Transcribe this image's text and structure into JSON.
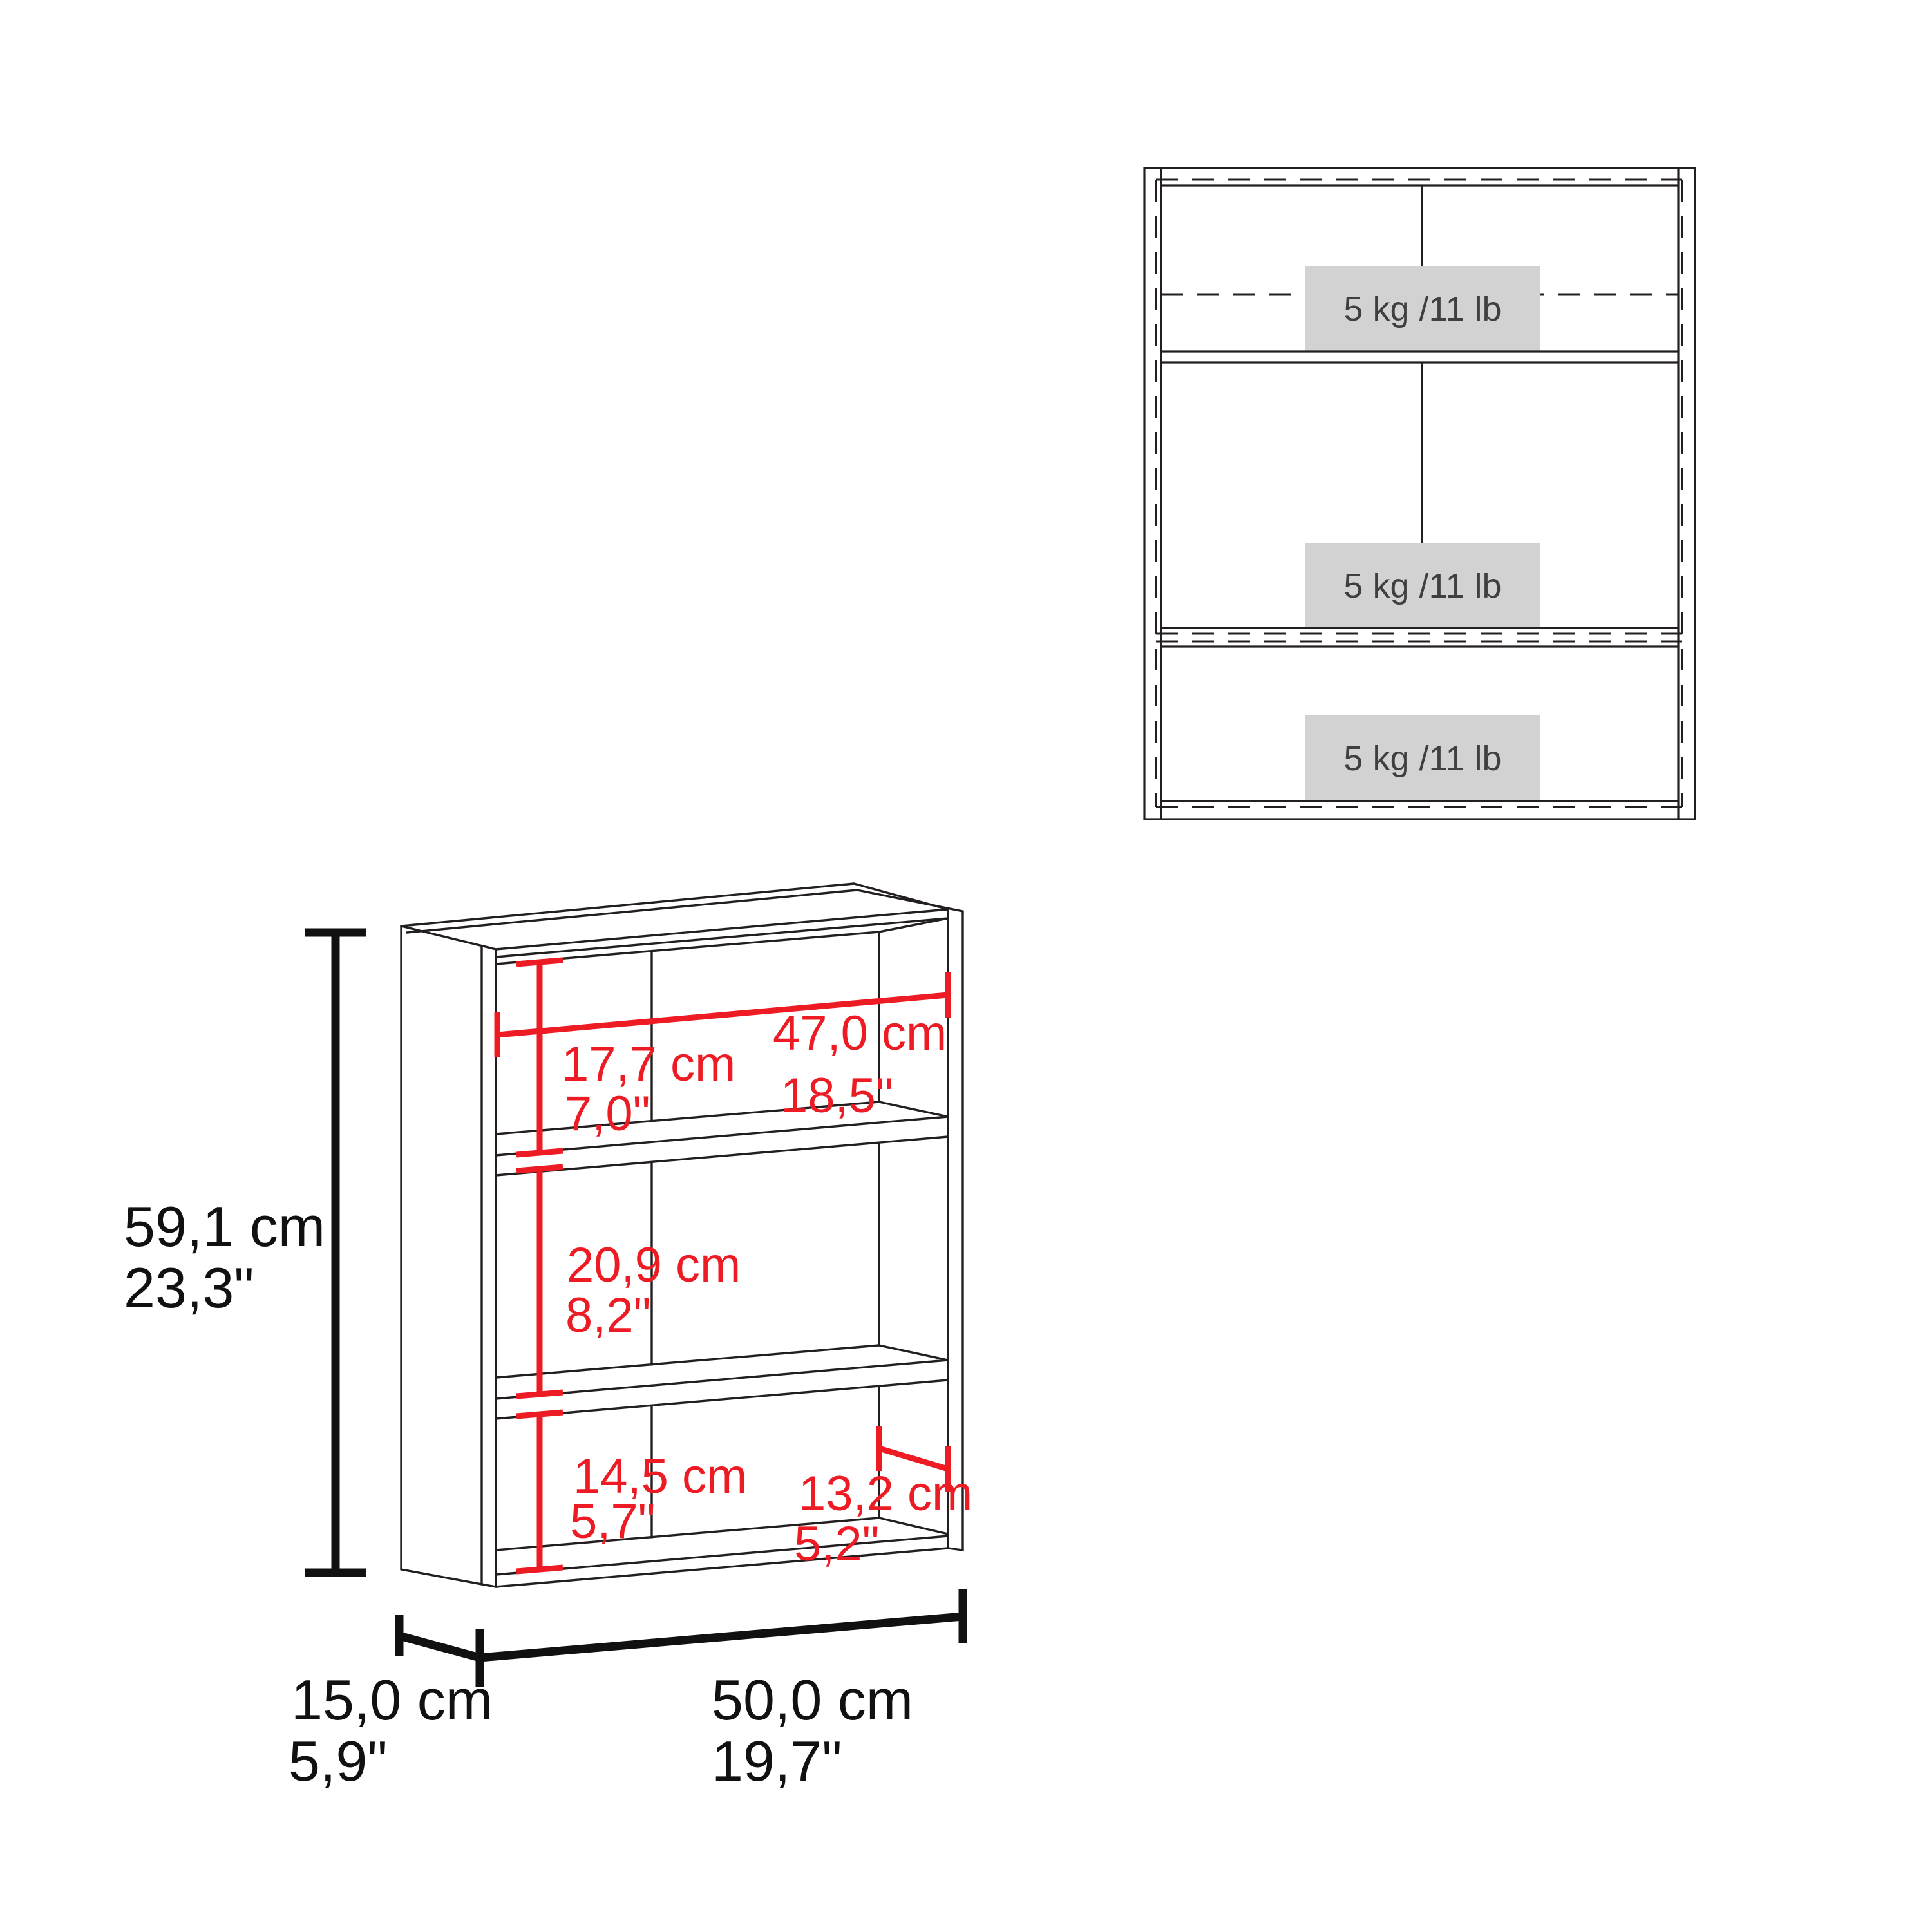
{
  "front_view": {
    "shelf_capacity_labels": [
      "5 kg /11 lb",
      "5 kg /11 lb",
      "5 kg /11 lb"
    ]
  },
  "dimensions": {
    "overall_height": {
      "cm": "59,1 cm",
      "in": "23,3\""
    },
    "depth": {
      "cm": "15,0 cm",
      "in": "5,9\""
    },
    "overall_width": {
      "cm": "50,0 cm",
      "in": "19,7\""
    },
    "inner_width": {
      "cm": "47,0 cm",
      "in": "18,5\""
    },
    "top_compartment_height": {
      "cm": "17,7 cm",
      "in": "7,0\""
    },
    "middle_compartment_height": {
      "cm": "20,9 cm",
      "in": "8,2\""
    },
    "bottom_compartment_height": {
      "cm": "14,5 cm",
      "in": "5,7\""
    },
    "inner_depth": {
      "cm": "13,2 cm",
      "in": "5,2\""
    }
  },
  "colors": {
    "dimension_red": "#ED1C24",
    "line_color": "#231f20",
    "capacity_box_bg": "#d2d2d2",
    "capacity_text": "#3f3f3f"
  }
}
